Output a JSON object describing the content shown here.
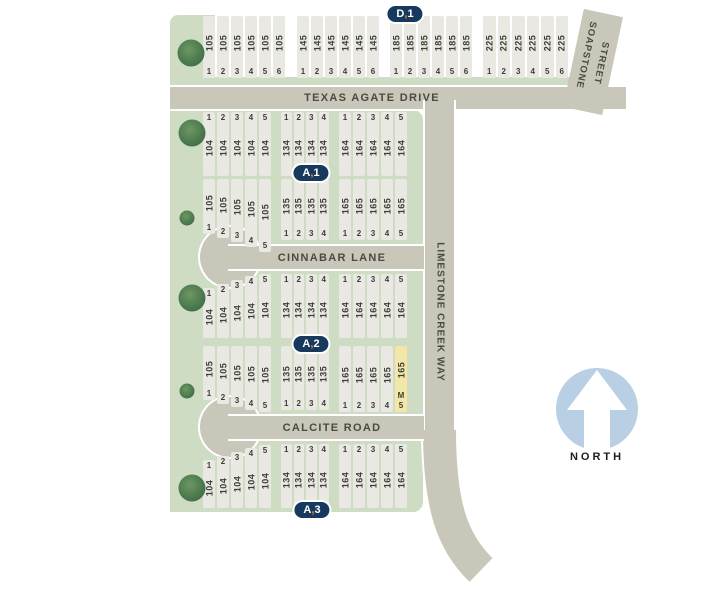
{
  "streets": {
    "texas_agate": "TEXAS AGATE DRIVE",
    "soapstone_line1": "SOAPSTONE",
    "soapstone_line2": "STREET",
    "cinnabar": "CINNABAR LANE",
    "calcite": "CALCITE ROAD",
    "limestone": "LIMESTONE CREEK WAY"
  },
  "north": {
    "label": "NORTH"
  },
  "badges": [
    {
      "text": "D,1"
    },
    {
      "text": "A,1"
    },
    {
      "text": "A,2"
    },
    {
      "text": "A,3"
    }
  ],
  "highlight": {
    "block": "165",
    "lot": "5",
    "tag": "M"
  },
  "blocks": [
    {
      "block": "105",
      "lots": [
        "1",
        "2",
        "3",
        "4",
        "5",
        "6"
      ]
    },
    {
      "block": "145",
      "lots": [
        "1",
        "2",
        "3",
        "4",
        "5",
        "6"
      ]
    },
    {
      "block": "185",
      "lots": [
        "1",
        "2",
        "3",
        "4",
        "5",
        "6"
      ]
    },
    {
      "block": "225",
      "lots": [
        "1",
        "2",
        "3",
        "4",
        "5",
        "6"
      ]
    },
    {
      "block": "104",
      "lots": [
        "1",
        "2",
        "3",
        "4",
        "5"
      ]
    },
    {
      "block": "134",
      "lots": [
        "1",
        "2",
        "3",
        "4"
      ]
    },
    {
      "block": "164",
      "lots": [
        "1",
        "2",
        "3",
        "4",
        "5"
      ]
    },
    {
      "block": "105",
      "lots": [
        "1",
        "2",
        "3",
        "4",
        "5"
      ]
    },
    {
      "block": "135",
      "lots": [
        "1",
        "2",
        "3",
        "4"
      ]
    },
    {
      "block": "165",
      "lots": [
        "1",
        "2",
        "3",
        "4",
        "5"
      ]
    },
    {
      "block": "104",
      "lots": [
        "1",
        "2",
        "3",
        "4",
        "5"
      ]
    },
    {
      "block": "134",
      "lots": [
        "1",
        "2",
        "3",
        "4"
      ]
    },
    {
      "block": "164",
      "lots": [
        "1",
        "2",
        "3",
        "4",
        "5"
      ]
    },
    {
      "block": "105",
      "lots": [
        "1",
        "2",
        "3",
        "4",
        "5"
      ]
    },
    {
      "block": "135",
      "lots": [
        "1",
        "2",
        "3",
        "4"
      ]
    },
    {
      "block": "165",
      "lots": [
        "1",
        "2",
        "3",
        "4",
        "5"
      ]
    },
    {
      "block": "104",
      "lots": [
        "1",
        "2",
        "3",
        "4",
        "5"
      ]
    },
    {
      "block": "134",
      "lots": [
        "1",
        "2",
        "3",
        "4"
      ]
    },
    {
      "block": "164",
      "lots": [
        "1",
        "2",
        "3",
        "4",
        "5"
      ]
    }
  ],
  "colors": {
    "road": "#c9c7ba",
    "green_space": "#cddcc2",
    "lot_fill": "#e9e8e3",
    "lot_highlight": "#f4e6a7",
    "badge_bg": "#17395e",
    "badge_comma": "#e8832c",
    "north_circle": "#b9cfe3",
    "tree_green": "#4c7a4f"
  }
}
